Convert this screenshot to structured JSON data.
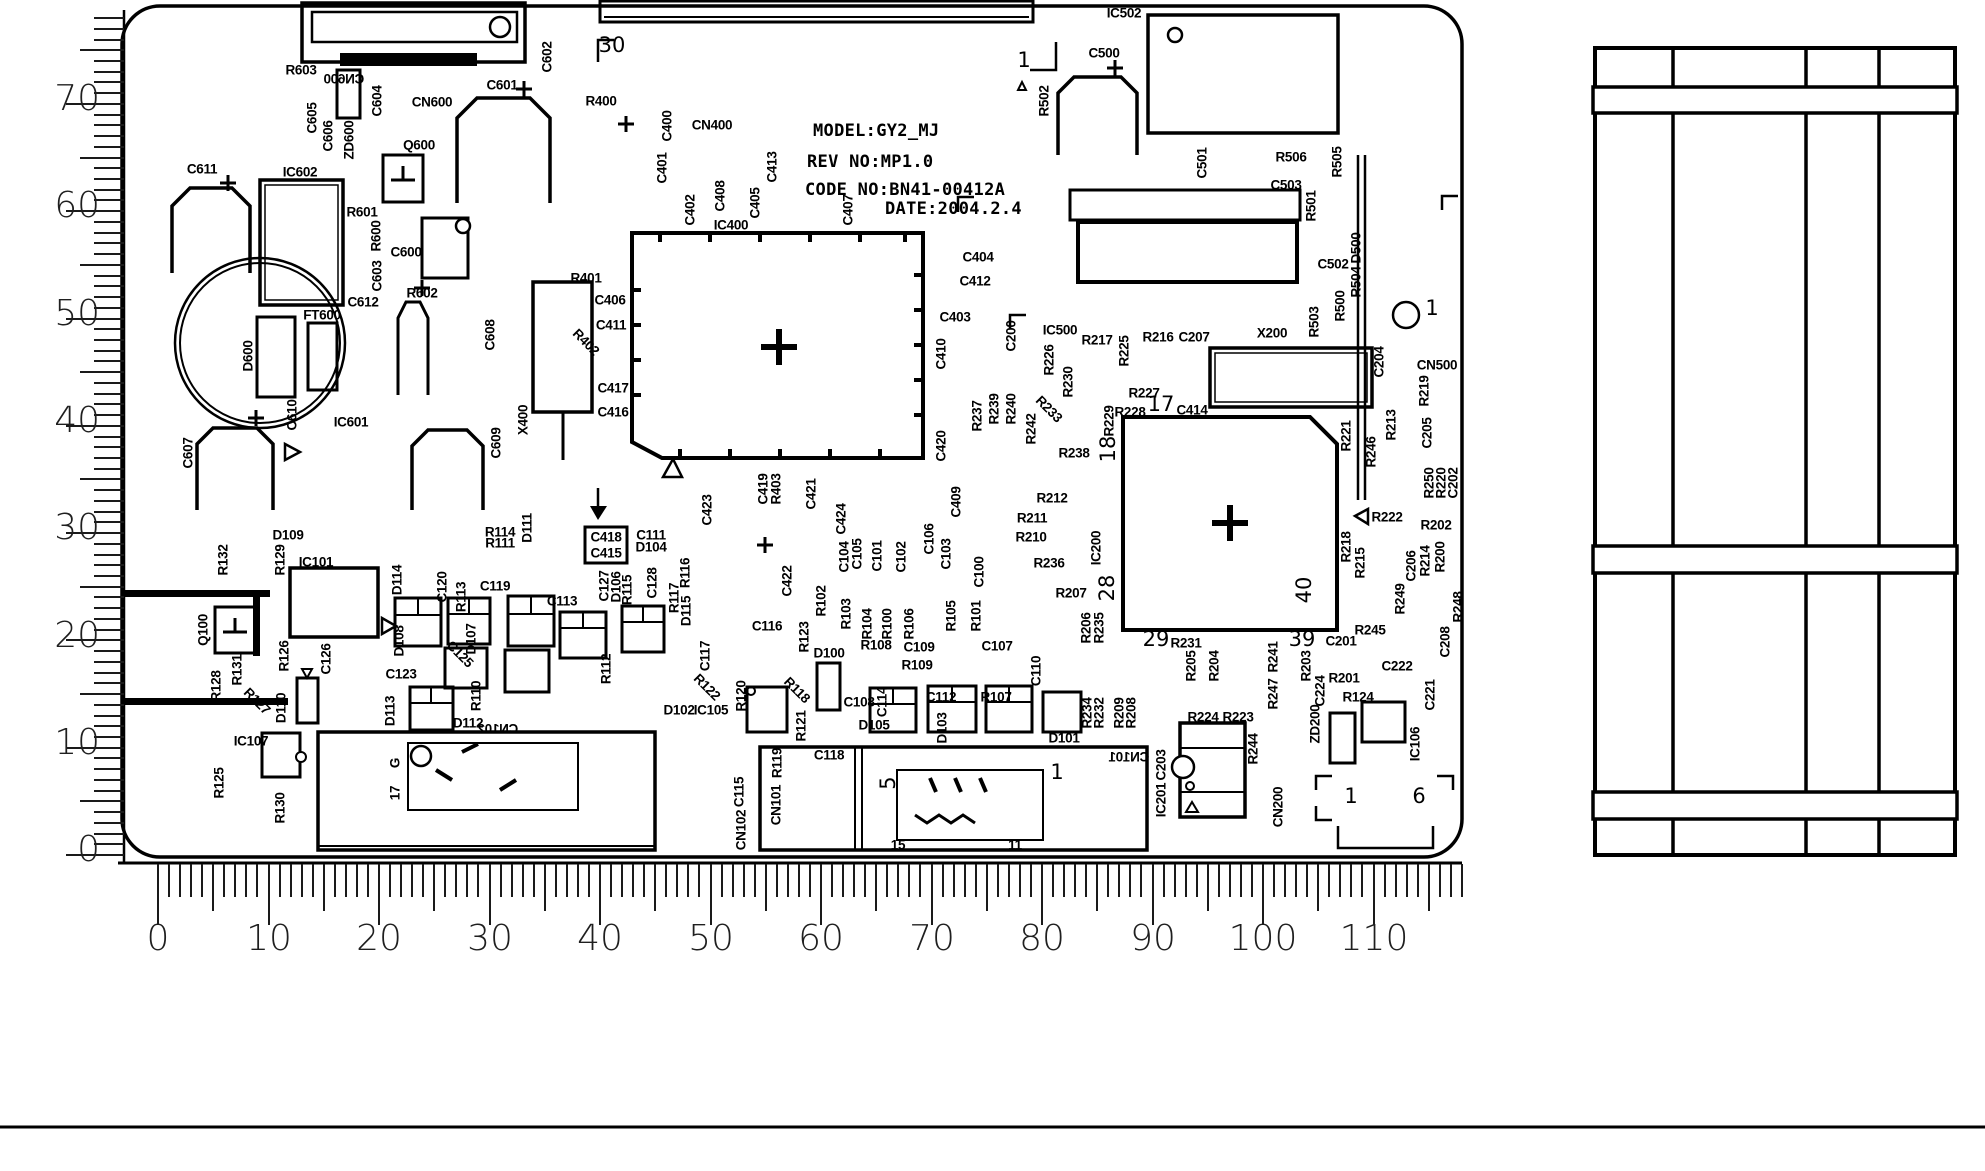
{
  "title_block": {
    "model": "MODEL:GY2_MJ",
    "rev": "REV NO:MP1.0",
    "code": "CODE NO:BN41-00412A",
    "date": "DATE:2004.2.4"
  },
  "rulers": {
    "left": {
      "edge_x": 124,
      "origin_y": 855,
      "step": 10.73,
      "max_mm": 78,
      "len": {
        "minor": 30,
        "mid": 44,
        "major": 58
      },
      "numbers": [
        {
          "v": "70",
          "y": 104
        },
        {
          "v": "60",
          "y": 211
        },
        {
          "v": "50",
          "y": 319
        },
        {
          "v": "40",
          "y": 426
        },
        {
          "v": "30",
          "y": 533
        },
        {
          "v": "20",
          "y": 641
        },
        {
          "v": "10",
          "y": 748
        },
        {
          "v": "0",
          "y": 855
        }
      ]
    },
    "bottom": {
      "edge_y": 864,
      "origin_x": 158,
      "step": 11.05,
      "max_mm": 118,
      "len": {
        "minor": 33,
        "mid": 47,
        "major": 61
      },
      "numbers": [
        {
          "v": "0",
          "x": 158
        },
        {
          "v": "10",
          "x": 269
        },
        {
          "v": "20",
          "x": 379
        },
        {
          "v": "30",
          "x": 490
        },
        {
          "v": "40",
          "x": 600
        },
        {
          "v": "50",
          "x": 711
        },
        {
          "v": "60",
          "x": 821
        },
        {
          "v": "70",
          "x": 932
        },
        {
          "v": "80",
          "x": 1042
        },
        {
          "v": "90",
          "x": 1153
        },
        {
          "v": "100",
          "x": 1263
        },
        {
          "v": "110",
          "x": 1374
        }
      ]
    }
  },
  "labels": [
    {
      "t": "R603",
      "x": 301,
      "y": 70
    },
    {
      "t": "CN600",
      "x": 344,
      "y": 79,
      "m": 1
    },
    {
      "t": "C605",
      "x": 312,
      "y": 118,
      "r": -90
    },
    {
      "t": "C606",
      "x": 328,
      "y": 136,
      "r": -90
    },
    {
      "t": "ZD600",
      "x": 349,
      "y": 140,
      "r": -90
    },
    {
      "t": "C604",
      "x": 377,
      "y": 101,
      "r": -90
    },
    {
      "t": "CN600",
      "x": 432,
      "y": 102
    },
    {
      "t": "C601",
      "x": 502,
      "y": 85
    },
    {
      "t": "C602",
      "x": 547,
      "y": 57,
      "r": -90
    },
    {
      "t": "Q600",
      "x": 419,
      "y": 145
    },
    {
      "t": "R400",
      "x": 601,
      "y": 101
    },
    {
      "t": "C400",
      "x": 667,
      "y": 126,
      "r": -90
    },
    {
      "t": "CN400",
      "x": 712,
      "y": 125
    },
    {
      "t": "C401",
      "x": 662,
      "y": 168,
      "r": -90
    },
    {
      "t": "C413",
      "x": 772,
      "y": 167,
      "r": -90
    },
    {
      "t": "C402",
      "x": 690,
      "y": 210,
      "r": -90
    },
    {
      "t": "C408",
      "x": 720,
      "y": 196,
      "r": -90
    },
    {
      "t": "C405",
      "x": 755,
      "y": 203,
      "r": -90
    },
    {
      "t": "IC400",
      "x": 731,
      "y": 225
    },
    {
      "t": "C407",
      "x": 848,
      "y": 210,
      "r": -90
    },
    {
      "t": "30",
      "x": 612,
      "y": 45,
      "big": 1
    },
    {
      "t": "1",
      "x": 1024,
      "y": 60,
      "big": 1
    },
    {
      "t": "IC502",
      "x": 1124,
      "y": 13
    },
    {
      "t": "R502",
      "x": 1044,
      "y": 101,
      "r": -90
    },
    {
      "t": "C500",
      "x": 1104,
      "y": 53
    },
    {
      "t": "C501",
      "x": 1202,
      "y": 163,
      "r": -90
    },
    {
      "t": "R506",
      "x": 1291,
      "y": 157
    },
    {
      "t": "C503",
      "x": 1286,
      "y": 185
    },
    {
      "t": "R501",
      "x": 1311,
      "y": 206,
      "r": -90
    },
    {
      "t": "C502",
      "x": 1333,
      "y": 264
    },
    {
      "t": "R505",
      "x": 1337,
      "y": 162,
      "r": -90
    },
    {
      "t": "D500",
      "x": 1356,
      "y": 248,
      "r": -90
    },
    {
      "t": "R504",
      "x": 1356,
      "y": 282,
      "r": -90
    },
    {
      "t": "R500",
      "x": 1340,
      "y": 306,
      "r": -90
    },
    {
      "t": "R503",
      "x": 1314,
      "y": 322,
      "r": -90
    },
    {
      "t": "1",
      "x": 1432,
      "y": 308,
      "big": 1
    },
    {
      "t": "C404",
      "x": 978,
      "y": 257
    },
    {
      "t": "C412",
      "x": 975,
      "y": 281
    },
    {
      "t": "C611",
      "x": 202,
      "y": 169
    },
    {
      "t": "IC602",
      "x": 300,
      "y": 172
    },
    {
      "t": "R601",
      "x": 362,
      "y": 212
    },
    {
      "t": "R600",
      "x": 376,
      "y": 236,
      "r": -90
    },
    {
      "t": "C600",
      "x": 406,
      "y": 252
    },
    {
      "t": "C603",
      "x": 377,
      "y": 276,
      "r": -90
    },
    {
      "t": "C612",
      "x": 363,
      "y": 302
    },
    {
      "t": "R602",
      "x": 422,
      "y": 293
    },
    {
      "t": "FT600",
      "x": 322,
      "y": 315
    },
    {
      "t": "D600",
      "x": 248,
      "y": 356,
      "r": -90
    },
    {
      "t": "C610",
      "x": 292,
      "y": 415,
      "r": -90
    },
    {
      "t": "IC601",
      "x": 351,
      "y": 422
    },
    {
      "t": "C607",
      "x": 188,
      "y": 453,
      "r": -90
    },
    {
      "t": "C608",
      "x": 490,
      "y": 335,
      "r": -90
    },
    {
      "t": "C609",
      "x": 496,
      "y": 443,
      "r": -90
    },
    {
      "t": "X400",
      "x": 523,
      "y": 420,
      "r": -90
    },
    {
      "t": "R401",
      "x": 586,
      "y": 278
    },
    {
      "t": "C406",
      "x": 610,
      "y": 300
    },
    {
      "t": "C411",
      "x": 611,
      "y": 325
    },
    {
      "t": "R402",
      "x": 586,
      "y": 342,
      "r": 45
    },
    {
      "t": "C417",
      "x": 613,
      "y": 388
    },
    {
      "t": "C416",
      "x": 613,
      "y": 412
    },
    {
      "t": "C403",
      "x": 955,
      "y": 317
    },
    {
      "t": "C410",
      "x": 941,
      "y": 354,
      "r": -90
    },
    {
      "t": "C420",
      "x": 941,
      "y": 446,
      "r": -90
    },
    {
      "t": "C200",
      "x": 1011,
      "y": 336,
      "r": -90
    },
    {
      "t": "IC500",
      "x": 1060,
      "y": 330
    },
    {
      "t": "R217",
      "x": 1097,
      "y": 340
    },
    {
      "t": "R225",
      "x": 1124,
      "y": 351,
      "r": -90
    },
    {
      "t": "R216",
      "x": 1158,
      "y": 337
    },
    {
      "t": "C207",
      "x": 1194,
      "y": 337
    },
    {
      "t": "X200",
      "x": 1272,
      "y": 333
    },
    {
      "t": "C204",
      "x": 1379,
      "y": 362,
      "r": -90
    },
    {
      "t": "CN500",
      "x": 1437,
      "y": 365
    },
    {
      "t": "R219",
      "x": 1424,
      "y": 391,
      "r": -90
    },
    {
      "t": "R226",
      "x": 1049,
      "y": 360,
      "r": -90
    },
    {
      "t": "R230",
      "x": 1068,
      "y": 382,
      "r": -90
    },
    {
      "t": "R240",
      "x": 1011,
      "y": 409,
      "r": -90
    },
    {
      "t": "R242",
      "x": 1031,
      "y": 429,
      "r": -90
    },
    {
      "t": "R233",
      "x": 1049,
      "y": 409,
      "r": 45
    },
    {
      "t": "R237",
      "x": 977,
      "y": 416,
      "r": -90
    },
    {
      "t": "R239",
      "x": 994,
      "y": 409,
      "r": -90
    },
    {
      "t": "R227",
      "x": 1144,
      "y": 393
    },
    {
      "t": "17",
      "x": 1161,
      "y": 404,
      "big": 1
    },
    {
      "t": "R228",
      "x": 1130,
      "y": 412
    },
    {
      "t": "R229",
      "x": 1109,
      "y": 421,
      "r": -90
    },
    {
      "t": "18",
      "x": 1108,
      "y": 449,
      "r": -90,
      "big": 1
    },
    {
      "t": "C414",
      "x": 1192,
      "y": 410
    },
    {
      "t": "R238",
      "x": 1074,
      "y": 453
    },
    {
      "t": "R212",
      "x": 1052,
      "y": 498
    },
    {
      "t": "R211",
      "x": 1032,
      "y": 518
    },
    {
      "t": "R210",
      "x": 1031,
      "y": 537
    },
    {
      "t": "R236",
      "x": 1049,
      "y": 563
    },
    {
      "t": "R207",
      "x": 1071,
      "y": 593
    },
    {
      "t": "IC200",
      "x": 1096,
      "y": 548,
      "r": -90
    },
    {
      "t": "28",
      "x": 1107,
      "y": 588,
      "r": -90,
      "big": 1
    },
    {
      "t": "R221",
      "x": 1346,
      "y": 436,
      "r": -90
    },
    {
      "t": "R246",
      "x": 1371,
      "y": 452,
      "r": -90
    },
    {
      "t": "R213",
      "x": 1391,
      "y": 425,
      "r": -90
    },
    {
      "t": "C205",
      "x": 1427,
      "y": 433,
      "r": -90
    },
    {
      "t": "R250",
      "x": 1429,
      "y": 483,
      "r": -90
    },
    {
      "t": "R220",
      "x": 1441,
      "y": 483,
      "r": -90
    },
    {
      "t": "C202",
      "x": 1453,
      "y": 483,
      "r": -90
    },
    {
      "t": "R222",
      "x": 1387,
      "y": 517
    },
    {
      "t": "R202",
      "x": 1436,
      "y": 525
    },
    {
      "t": "R218",
      "x": 1346,
      "y": 547,
      "r": -90
    },
    {
      "t": "R215",
      "x": 1360,
      "y": 563,
      "r": -90
    },
    {
      "t": "C206",
      "x": 1411,
      "y": 566,
      "r": -90
    },
    {
      "t": "R214",
      "x": 1425,
      "y": 561,
      "r": -90
    },
    {
      "t": "R200",
      "x": 1440,
      "y": 557,
      "r": -90
    },
    {
      "t": "40",
      "x": 1304,
      "y": 590,
      "r": -90,
      "big": 1
    },
    {
      "t": "R249",
      "x": 1400,
      "y": 599,
      "r": -90
    },
    {
      "t": "C208",
      "x": 1445,
      "y": 642,
      "r": -90
    },
    {
      "t": "R248",
      "x": 1458,
      "y": 607,
      "r": -90
    },
    {
      "t": "R245",
      "x": 1370,
      "y": 630
    },
    {
      "t": "C201",
      "x": 1341,
      "y": 641
    },
    {
      "t": "C222",
      "x": 1397,
      "y": 666
    },
    {
      "t": "R201",
      "x": 1344,
      "y": 678
    },
    {
      "t": "R124",
      "x": 1358,
      "y": 697
    },
    {
      "t": "C224",
      "x": 1320,
      "y": 691,
      "r": -90
    },
    {
      "t": "ZD200",
      "x": 1315,
      "y": 724,
      "r": -90
    },
    {
      "t": "C221",
      "x": 1430,
      "y": 695,
      "r": -90
    },
    {
      "t": "IC106",
      "x": 1415,
      "y": 744,
      "r": -90
    },
    {
      "t": "R206",
      "x": 1086,
      "y": 628,
      "r": -90
    },
    {
      "t": "R235",
      "x": 1099,
      "y": 628,
      "r": -90
    },
    {
      "t": "29",
      "x": 1156,
      "y": 639,
      "big": 1
    },
    {
      "t": "R231",
      "x": 1186,
      "y": 643
    },
    {
      "t": "R205",
      "x": 1191,
      "y": 666,
      "r": -90
    },
    {
      "t": "R204",
      "x": 1214,
      "y": 666,
      "r": -90
    },
    {
      "t": "R234",
      "x": 1087,
      "y": 713,
      "r": -90
    },
    {
      "t": "R232",
      "x": 1099,
      "y": 713,
      "r": -90
    },
    {
      "t": "R209",
      "x": 1119,
      "y": 713,
      "r": -90
    },
    {
      "t": "R208",
      "x": 1131,
      "y": 713,
      "r": -90
    },
    {
      "t": "D101",
      "x": 1064,
      "y": 738
    },
    {
      "t": "R247",
      "x": 1273,
      "y": 694,
      "r": -90
    },
    {
      "t": "R241",
      "x": 1273,
      "y": 657,
      "r": -90
    },
    {
      "t": "R203",
      "x": 1306,
      "y": 666,
      "r": -90
    },
    {
      "t": "39",
      "x": 1302,
      "y": 639,
      "big": 1
    },
    {
      "t": "R224",
      "x": 1203,
      "y": 717
    },
    {
      "t": "R223",
      "x": 1238,
      "y": 717
    },
    {
      "t": "R244",
      "x": 1253,
      "y": 749,
      "r": -90
    },
    {
      "t": "IC201",
      "x": 1161,
      "y": 800,
      "r": -90
    },
    {
      "t": "C203",
      "x": 1161,
      "y": 765,
      "r": -90
    },
    {
      "t": "CN200",
      "x": 1278,
      "y": 807,
      "r": -90
    },
    {
      "t": "CN101",
      "x": 1129,
      "y": 757,
      "m": 1
    },
    {
      "t": "1",
      "x": 1351,
      "y": 796,
      "big": 1
    },
    {
      "t": "6",
      "x": 1419,
      "y": 796,
      "big": 1
    },
    {
      "t": "R114",
      "x": 500,
      "y": 532
    },
    {
      "t": "R111",
      "x": 500,
      "y": 543
    },
    {
      "t": "D111",
      "x": 527,
      "y": 528,
      "r": -90
    },
    {
      "t": "C111",
      "x": 651,
      "y": 535
    },
    {
      "t": "D104",
      "x": 651,
      "y": 547
    },
    {
      "t": "C423",
      "x": 707,
      "y": 510,
      "r": -90
    },
    {
      "t": "C418",
      "x": 606,
      "y": 537
    },
    {
      "t": "C415",
      "x": 606,
      "y": 553
    },
    {
      "t": "C419",
      "x": 763,
      "y": 489,
      "r": -90
    },
    {
      "t": "R403",
      "x": 776,
      "y": 489,
      "r": -90
    },
    {
      "t": "C421",
      "x": 811,
      "y": 494,
      "r": -90
    },
    {
      "t": "C424",
      "x": 841,
      "y": 519,
      "r": -90
    },
    {
      "t": "C104",
      "x": 844,
      "y": 557,
      "r": -90
    },
    {
      "t": "C105",
      "x": 857,
      "y": 554,
      "r": -90
    },
    {
      "t": "C101",
      "x": 877,
      "y": 556,
      "r": -90
    },
    {
      "t": "C102",
      "x": 901,
      "y": 557,
      "r": -90
    },
    {
      "t": "C106",
      "x": 929,
      "y": 539,
      "r": -90
    },
    {
      "t": "C103",
      "x": 946,
      "y": 554,
      "r": -90
    },
    {
      "t": "C409",
      "x": 956,
      "y": 502,
      "r": -90
    },
    {
      "t": "C100",
      "x": 979,
      "y": 572,
      "r": -90
    },
    {
      "t": "C422",
      "x": 787,
      "y": 581,
      "r": -90
    },
    {
      "t": "R102",
      "x": 821,
      "y": 601,
      "r": -90
    },
    {
      "t": "R103",
      "x": 846,
      "y": 614,
      "r": -90
    },
    {
      "t": "R104",
      "x": 867,
      "y": 624,
      "r": -90
    },
    {
      "t": "R100",
      "x": 887,
      "y": 624,
      "r": -90
    },
    {
      "t": "R106",
      "x": 909,
      "y": 624,
      "r": -90
    },
    {
      "t": "R105",
      "x": 951,
      "y": 616,
      "r": -90
    },
    {
      "t": "R101",
      "x": 976,
      "y": 616,
      "r": -90
    },
    {
      "t": "R108",
      "x": 876,
      "y": 645
    },
    {
      "t": "C109",
      "x": 919,
      "y": 647
    },
    {
      "t": "R109",
      "x": 917,
      "y": 665
    },
    {
      "t": "C107",
      "x": 997,
      "y": 646
    },
    {
      "t": "C110",
      "x": 1036,
      "y": 671,
      "r": -90
    },
    {
      "t": "D100",
      "x": 829,
      "y": 653
    },
    {
      "t": "C108",
      "x": 859,
      "y": 702
    },
    {
      "t": "C114",
      "x": 882,
      "y": 702,
      "r": -90
    },
    {
      "t": "C112",
      "x": 941,
      "y": 697
    },
    {
      "t": "R107",
      "x": 996,
      "y": 697
    },
    {
      "t": "D105",
      "x": 874,
      "y": 725
    },
    {
      "t": "D103",
      "x": 942,
      "y": 728,
      "r": -90
    },
    {
      "t": "C118",
      "x": 829,
      "y": 755
    },
    {
      "t": "R119",
      "x": 777,
      "y": 763,
      "r": -90
    },
    {
      "t": "C115",
      "x": 739,
      "y": 792,
      "r": -90
    },
    {
      "t": "CN102",
      "x": 741,
      "y": 830,
      "r": -90
    },
    {
      "t": "CN101",
      "x": 776,
      "y": 805,
      "r": -90
    },
    {
      "t": "R123",
      "x": 804,
      "y": 637,
      "r": -90
    },
    {
      "t": "C116",
      "x": 767,
      "y": 626
    },
    {
      "t": "C117",
      "x": 705,
      "y": 656,
      "r": -90
    },
    {
      "t": "R122",
      "x": 707,
      "y": 687,
      "r": 45
    },
    {
      "t": "R120",
      "x": 741,
      "y": 696,
      "r": -90
    },
    {
      "t": "R121",
      "x": 801,
      "y": 726,
      "r": -90
    },
    {
      "t": "R118",
      "x": 797,
      "y": 690,
      "r": 45
    },
    {
      "t": "D102",
      "x": 679,
      "y": 710
    },
    {
      "t": "IC105",
      "x": 711,
      "y": 710
    },
    {
      "t": "R116",
      "x": 685,
      "y": 573,
      "r": -90
    },
    {
      "t": "R117",
      "x": 674,
      "y": 598,
      "r": -90
    },
    {
      "t": "C128",
      "x": 652,
      "y": 583,
      "r": -90
    },
    {
      "t": "D115",
      "x": 686,
      "y": 611,
      "r": -90
    },
    {
      "t": "R115",
      "x": 627,
      "y": 590,
      "r": -90
    },
    {
      "t": "D106",
      "x": 616,
      "y": 587,
      "r": -90
    },
    {
      "t": "C127",
      "x": 604,
      "y": 586,
      "r": -90
    },
    {
      "t": "C113",
      "x": 562,
      "y": 601
    },
    {
      "t": "C119",
      "x": 495,
      "y": 586
    },
    {
      "t": "R113",
      "x": 461,
      "y": 597,
      "r": -90
    },
    {
      "t": "C120",
      "x": 442,
      "y": 587,
      "r": -90
    },
    {
      "t": "D114",
      "x": 397,
      "y": 580,
      "r": -90
    },
    {
      "t": "D108",
      "x": 399,
      "y": 641,
      "r": -90
    },
    {
      "t": "C125",
      "x": 460,
      "y": 654,
      "r": 45
    },
    {
      "t": "D107",
      "x": 471,
      "y": 639,
      "r": -90
    },
    {
      "t": "C123",
      "x": 401,
      "y": 674
    },
    {
      "t": "R110",
      "x": 476,
      "y": 696,
      "r": -90
    },
    {
      "t": "R112",
      "x": 606,
      "y": 669,
      "r": -90
    },
    {
      "t": "C126",
      "x": 326,
      "y": 659,
      "r": -90
    },
    {
      "t": "R126",
      "x": 284,
      "y": 656,
      "r": -90
    },
    {
      "t": "D110",
      "x": 281,
      "y": 708,
      "r": -90
    },
    {
      "t": "R127",
      "x": 257,
      "y": 701,
      "r": 45
    },
    {
      "t": "R131",
      "x": 237,
      "y": 670,
      "r": -90
    },
    {
      "t": "R128",
      "x": 216,
      "y": 686,
      "r": -90
    },
    {
      "t": "Q100",
      "x": 203,
      "y": 630,
      "r": -90
    },
    {
      "t": "R132",
      "x": 223,
      "y": 560,
      "r": -90
    },
    {
      "t": "R129",
      "x": 280,
      "y": 560,
      "r": -90
    },
    {
      "t": "D109",
      "x": 288,
      "y": 535
    },
    {
      "t": "IC101",
      "x": 316,
      "y": 562
    },
    {
      "t": "D113",
      "x": 390,
      "y": 711,
      "r": -90
    },
    {
      "t": "D112",
      "x": 468,
      "y": 723
    },
    {
      "t": "CN102",
      "x": 498,
      "y": 729,
      "m": 1
    },
    {
      "t": "IC107",
      "x": 251,
      "y": 741
    },
    {
      "t": "R130",
      "x": 280,
      "y": 808,
      "r": -90
    },
    {
      "t": "R125",
      "x": 219,
      "y": 783,
      "r": -90
    },
    {
      "t": "G",
      "x": 395,
      "y": 763,
      "r": -90
    },
    {
      "t": "17",
      "x": 395,
      "y": 793,
      "r": -90
    },
    {
      "t": "5",
      "x": 888,
      "y": 783,
      "r": -90,
      "big": 1
    },
    {
      "t": "1",
      "x": 1057,
      "y": 772,
      "big": 1
    },
    {
      "t": "15",
      "x": 898,
      "y": 845
    },
    {
      "t": "11",
      "x": 1015,
      "y": 845
    }
  ]
}
